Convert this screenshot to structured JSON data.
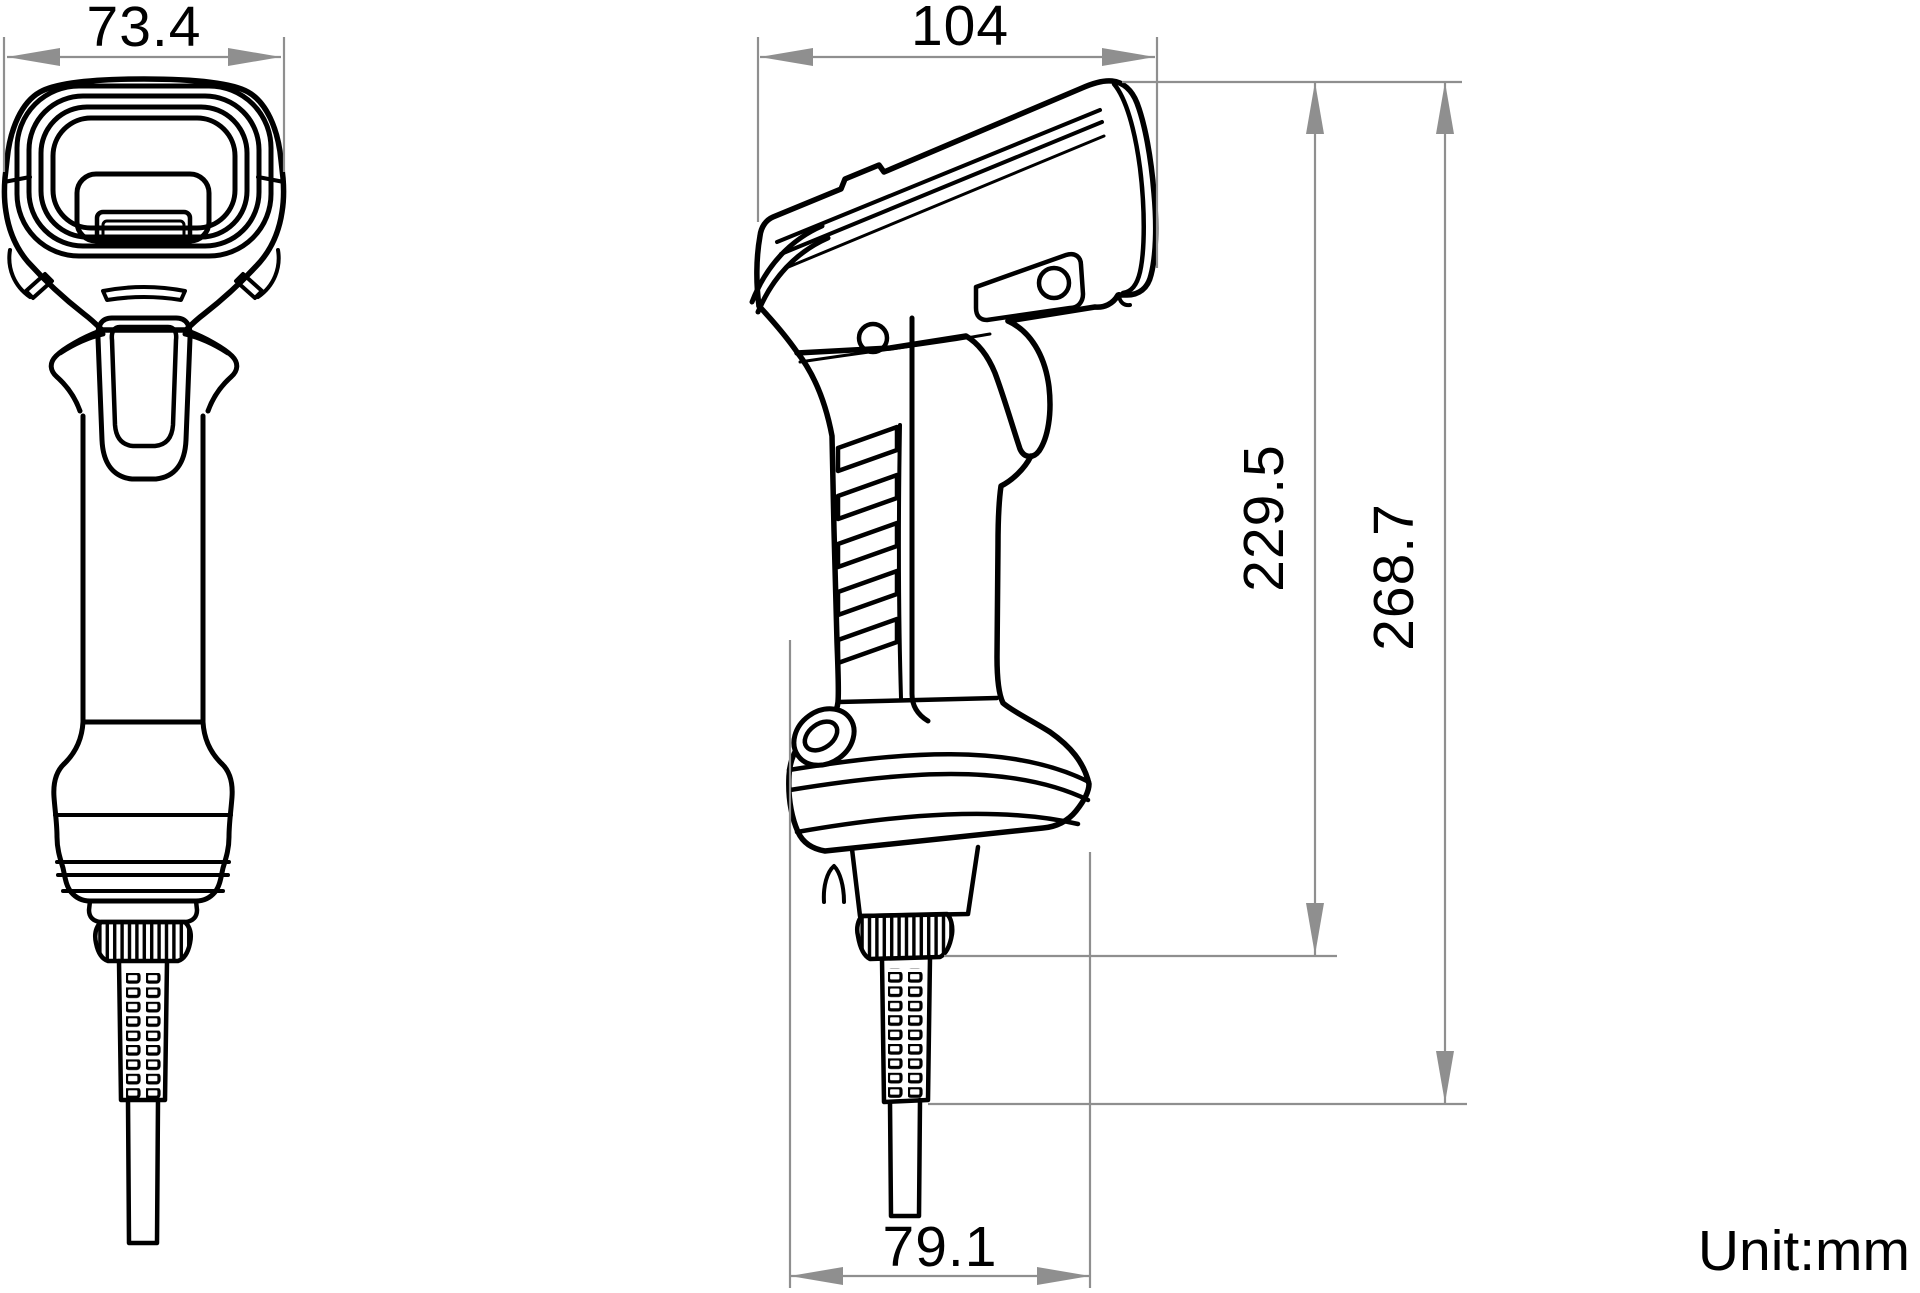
{
  "drawing": {
    "type": "technical-dimension-drawing",
    "subject": "handheld-barcode-scanner",
    "views": [
      "front-view",
      "side-view"
    ],
    "unit_label": "Unit:mm",
    "dimensions": {
      "front_width": "73.4",
      "side_length": "104",
      "body_height": "229.5",
      "overall_height": "268.7",
      "base_depth": "79.1"
    },
    "colors": {
      "outline": "#000000",
      "dimension_gray": "#8f8f8f",
      "background": "#ffffff"
    }
  }
}
